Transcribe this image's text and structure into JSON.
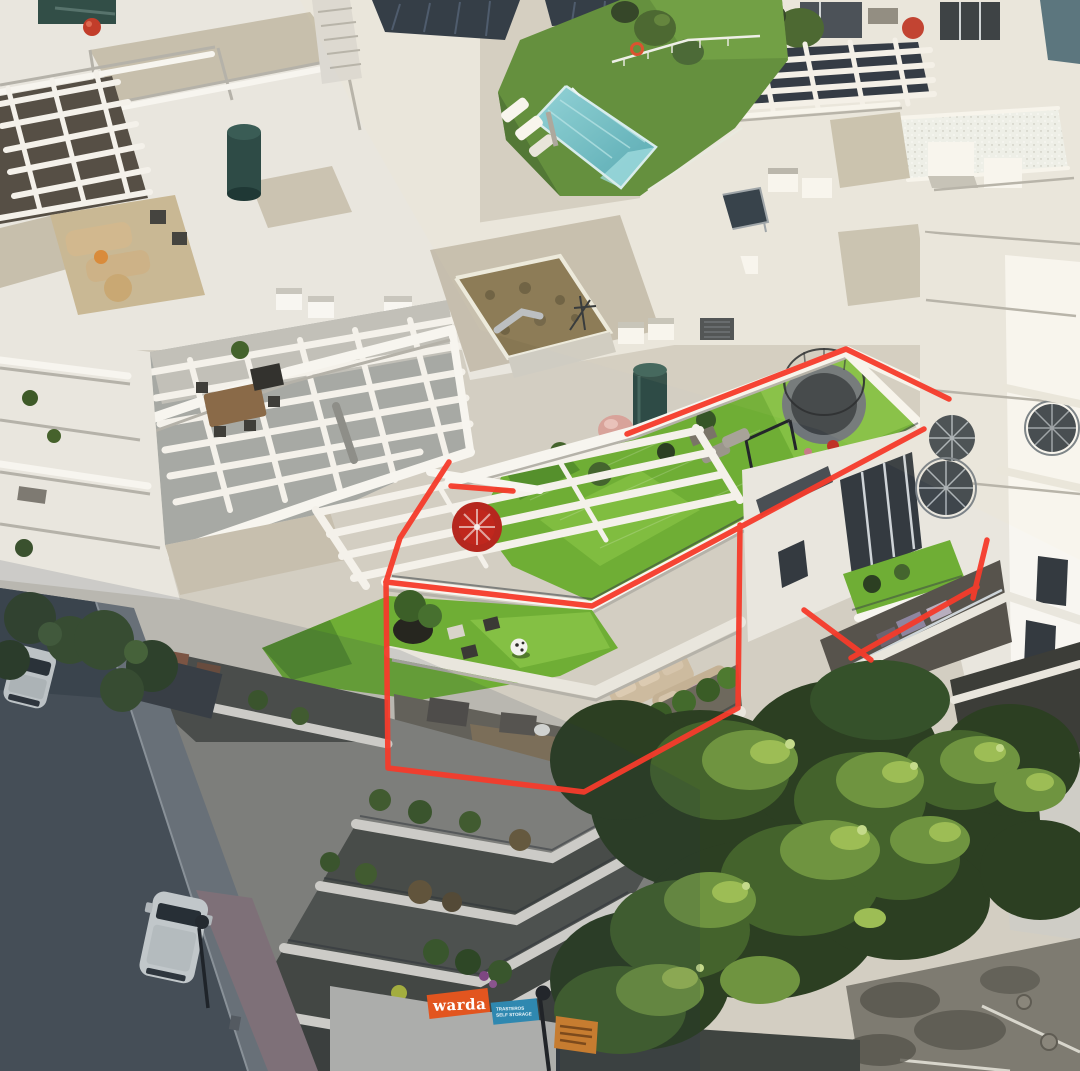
{
  "scene": {
    "description": "Aerial drone photo of a white Mediterranean apartment complex; a bright red hand-drawn outline highlights a corner duplex penthouse with artificial-turf roof terrace, trampoline, pergola and two lower terraces; swimming pool and lawn at top, shaded street with parked white cars at left, sunlit trees and parking at bottom right.",
    "lighting": "low sun from upper right, long shadows lower left"
  },
  "annotation": {
    "color": "#f63b2b",
    "stroke_width": 5.5,
    "strokes": {
      "roof_top_edge": [
        [
          627,
          434
        ],
        [
          846,
          349
        ],
        [
          949,
          399
        ]
      ],
      "pergola_left_edge": [
        [
          451,
          486
        ],
        [
          513,
          491
        ]
      ],
      "left_upper_diagonal": [
        [
          449,
          462
        ],
        [
          400,
          538
        ],
        [
          386,
          582
        ]
      ],
      "upper_terrace_parapet": [
        [
          386,
          582
        ],
        [
          592,
          606
        ],
        [
          924,
          429
        ]
      ],
      "lower_floor_outline": [
        [
          740,
          525
        ],
        [
          738,
          708
        ],
        [
          584,
          792
        ],
        [
          388,
          768
        ],
        [
          386,
          582
        ]
      ],
      "division_long": [
        [
          851,
          658
        ],
        [
          977,
          587
        ]
      ],
      "division_tick": [
        [
          804,
          610
        ],
        [
          871,
          660
        ]
      ],
      "division_steep": [
        [
          987,
          540
        ],
        [
          973,
          598
        ]
      ]
    }
  },
  "signs": {
    "warda": {
      "text": "warda",
      "bg": "#e2551f",
      "fg": "#ffffff"
    },
    "storage": {
      "line1": "TRASTEROS",
      "line2": "SELF STORAGE",
      "bg": "#2f88b0",
      "fg": "#ffffff"
    }
  },
  "objects": {
    "pool": "swimming pool with lap lane",
    "trampoline": "trampoline with safety net on turf roof terrace",
    "spiral_staircases": 3,
    "parked_vehicles": [
      "white car",
      "white van"
    ],
    "rooftop_items": [
      "pergolas",
      "solar panels",
      "air-conditioning units",
      "teal water tank",
      "red wheel ornament",
      "pink dome tent",
      "soccer ball",
      "beige outdoor sofas"
    ]
  },
  "palette": {
    "red": "#f63b2b",
    "wall": "#e9e6de",
    "wall_bright": "#f8f6f1",
    "wall_shade": "#b7b4ab",
    "glass": "#343a40",
    "turf": "#6fae35",
    "turf_dark": "#55902c",
    "turf_bright": "#84c044",
    "lawn": "#5d8c38",
    "pool": "#5fb3bd",
    "pool_light": "#9ddce2",
    "tree_dark": "#2c3f22",
    "tree_mid": "#44632c",
    "tree_lit": "#6f9440",
    "tree_hi": "#9dbd55",
    "street": "#4a535a",
    "sidewalk": "#747b81",
    "pavement": "#7e7b71",
    "warda": "#e2551f",
    "signblue": "#2f88b0",
    "signorange": "#c67c30",
    "tank": "#2e4b46",
    "wheel": "#c0271d",
    "dome": "#d8a39a"
  }
}
